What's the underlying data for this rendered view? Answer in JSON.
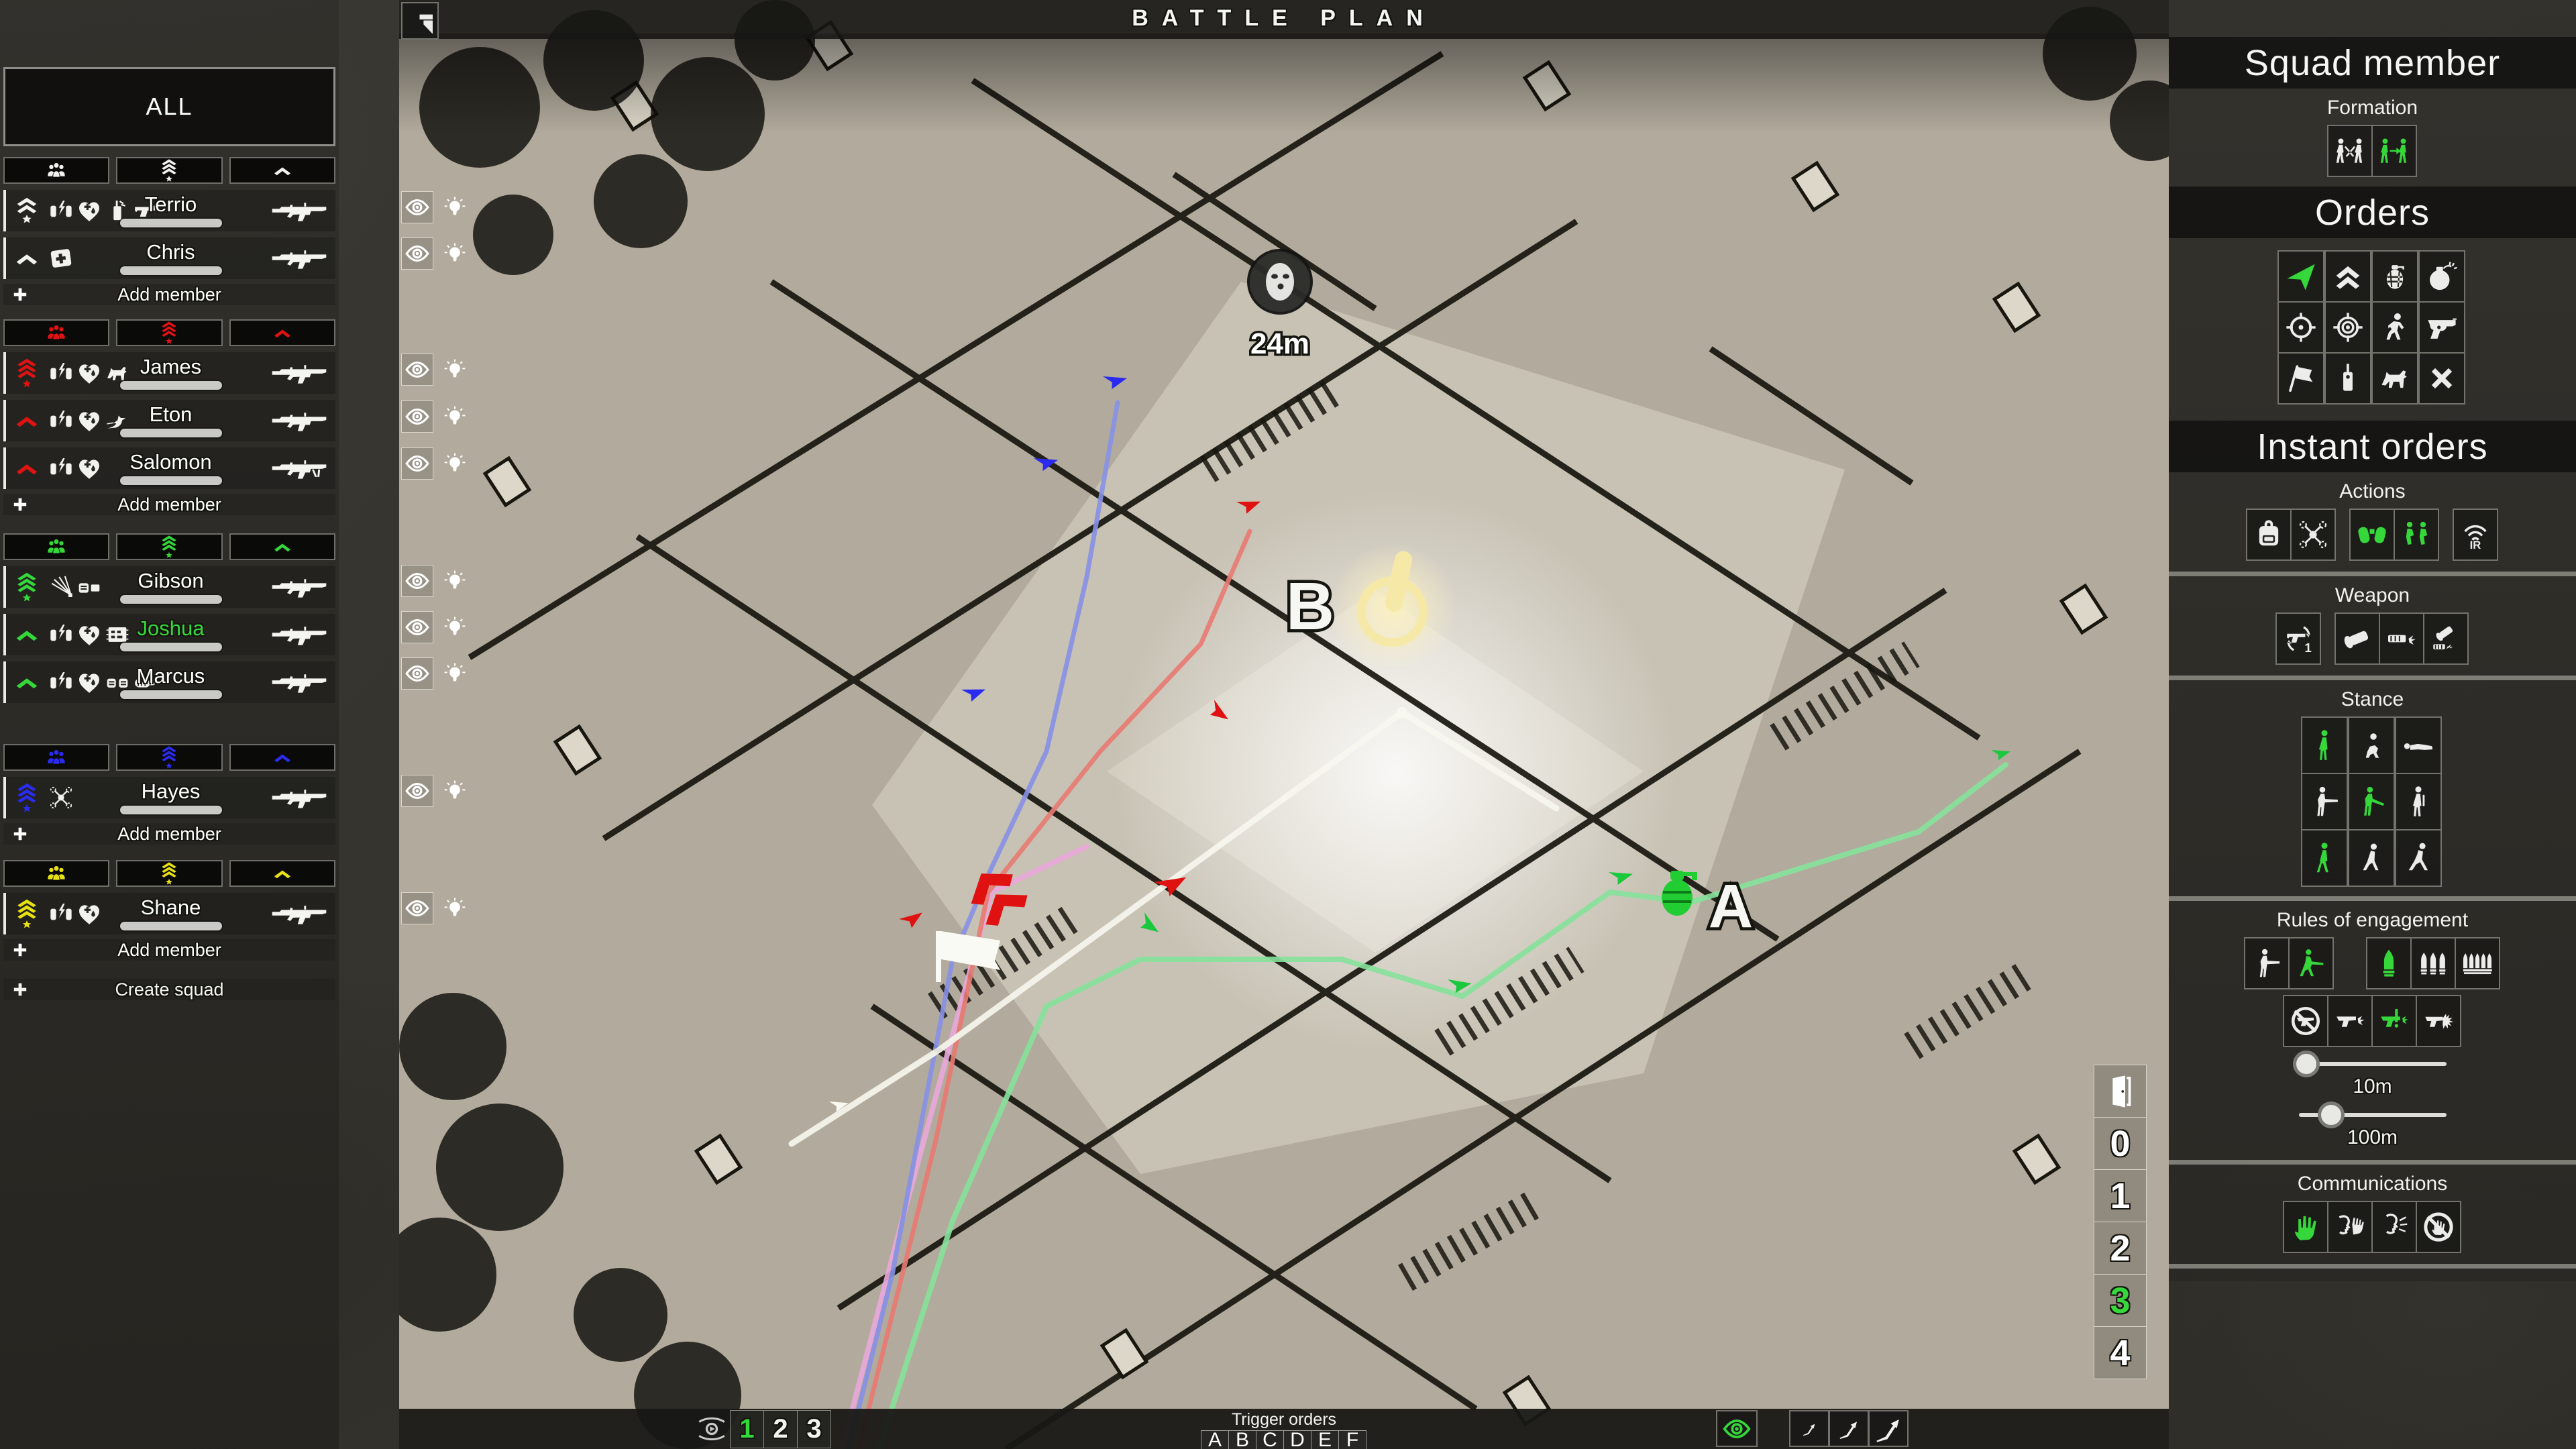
{
  "colors": {
    "accent_green": "#35d73a",
    "squad_white": "#f2f2ee",
    "squad_red": "#e01313",
    "squad_green": "#35d73a",
    "squad_blue": "#2b2bf0",
    "squad_yellow": "#e8e112"
  },
  "title_bar": {
    "title": "BATTLE PLAN"
  },
  "left_panel": {
    "all_label": "ALL",
    "filter_icons": [
      "group",
      "rank-3-star",
      "chevron"
    ],
    "squads": [
      {
        "color": "#f2f2ee",
        "add_label": "Add member",
        "members": [
          {
            "name": "Terrio",
            "rank": "rank-2-star",
            "skills": [
              "hands-lightning",
              "heart-medic",
              "radio",
              "pistol-small"
            ],
            "weapon": "rifle"
          },
          {
            "name": "Chris",
            "rank": "chevron",
            "skills": [
              "medkit"
            ],
            "weapon": "rifle"
          }
        ]
      },
      {
        "color": "#e01313",
        "add_label": "Add member",
        "members": [
          {
            "name": "James",
            "rank": "rank-3-star",
            "skills": [
              "hands-lightning",
              "heart-medic",
              "dog"
            ],
            "weapon": "rifle"
          },
          {
            "name": "Eton",
            "rank": "chevron",
            "skills": [
              "hands-lightning",
              "heart-medic",
              "bird"
            ],
            "weapon": "rifle"
          },
          {
            "name": "Salomon",
            "rank": "chevron",
            "skills": [
              "hands-lightning",
              "heart-medic"
            ],
            "weapon": "machine-gun"
          }
        ]
      },
      {
        "color": "#35d73a",
        "members": [
          {
            "name": "Gibson",
            "rank": "rank-3-star",
            "skills": [
              "breach-spray",
              "fist-wall"
            ],
            "weapon": "rifle"
          },
          {
            "name": "Joshua",
            "rank": "chevron",
            "skills": [
              "hands-lightning",
              "heart-medic",
              "circuit-board"
            ],
            "weapon": "rifle",
            "selected": true
          },
          {
            "name": "Marcus",
            "rank": "chevron",
            "skills": [
              "hands-lightning",
              "heart-medic",
              "fists",
              "bandage"
            ],
            "weapon": "rifle"
          }
        ]
      },
      {
        "color": "#2b2bf0",
        "add_label": "Add member",
        "members": [
          {
            "name": "Hayes",
            "rank": "rank-3-star",
            "skills": [
              "drone"
            ],
            "weapon": "rifle"
          }
        ]
      },
      {
        "color": "#e8e112",
        "add_label": "Add member",
        "members": [
          {
            "name": "Shane",
            "rank": "rank-3-star",
            "skills": [
              "hands-lightning",
              "heart-medic"
            ],
            "weapon": "rifle"
          }
        ]
      }
    ],
    "create_label": "Create squad"
  },
  "map": {
    "enemy_distance": "24m",
    "objective_a_label": "A",
    "objective_b_label": "B",
    "member_rows": [
      309,
      378,
      551,
      621,
      691,
      866,
      935,
      1004,
      1179,
      1354
    ],
    "floor_selector": {
      "door_icon": "door",
      "levels": [
        {
          "label": "0"
        },
        {
          "label": "1"
        },
        {
          "label": "2"
        },
        {
          "label": "3",
          "sel": true
        },
        {
          "label": "4"
        }
      ]
    }
  },
  "right_panel": {
    "squad_member_title": "Squad member",
    "formation_label": "Formation",
    "formation_options": [
      {
        "icon": "men-cross"
      },
      {
        "icon": "men-arrow",
        "sel": true
      }
    ],
    "orders_title": "Orders",
    "orders": [
      {
        "icon": "move-arrow",
        "sel": true
      },
      {
        "icon": "rush-chevrons"
      },
      {
        "icon": "grenade"
      },
      {
        "icon": "bomb"
      },
      {
        "icon": "crosshair"
      },
      {
        "icon": "focus-target"
      },
      {
        "icon": "crouch-run"
      },
      {
        "icon": "pistol-big"
      },
      {
        "icon": "flag"
      },
      {
        "icon": "detonator"
      },
      {
        "icon": "dog"
      },
      {
        "icon": "cancel-x"
      }
    ],
    "instant_orders_title": "Instant orders",
    "actions_label": "Actions",
    "actions_g1": [
      {
        "icon": "backpack"
      },
      {
        "icon": "drone"
      }
    ],
    "actions_g2": [
      {
        "icon": "binoculars",
        "sel": true
      },
      {
        "icon": "kneel-duo",
        "sel": true
      }
    ],
    "actions_g3": [
      {
        "icon": "ir-light"
      }
    ],
    "weapon_label": "Weapon",
    "weapon_g1": [
      {
        "icon": "pistol-swap"
      }
    ],
    "weapon_g2": [
      {
        "icon": "flashlight"
      },
      {
        "icon": "suppressor"
      },
      {
        "icon": "flash-suppressor"
      }
    ],
    "stance_label": "Stance",
    "stance": [
      {
        "icon": "stance-stand",
        "sel": true
      },
      {
        "icon": "stance-crouch"
      },
      {
        "icon": "stance-prone"
      },
      {
        "icon": "stance-aim"
      },
      {
        "icon": "stance-low",
        "sel": true
      },
      {
        "icon": "stance-relax"
      },
      {
        "icon": "stance-walk",
        "sel": true
      },
      {
        "icon": "stance-jog"
      },
      {
        "icon": "stance-run"
      }
    ],
    "roe_label": "Rules of engagement",
    "roe_g1": [
      {
        "icon": "roe-hold"
      },
      {
        "icon": "roe-advance",
        "sel": true
      }
    ],
    "roe_bullets": [
      {
        "icon": "bullet-1",
        "sel": true
      },
      {
        "icon": "bullet-3"
      },
      {
        "icon": "bullet-5"
      }
    ],
    "roe_fire": [
      {
        "icon": "no-fire"
      },
      {
        "icon": "fire-single"
      },
      {
        "icon": "fire-warn",
        "sel": true
      },
      {
        "icon": "fire-burst"
      }
    ],
    "sliders": [
      {
        "label": "10m",
        "pos": 0.05
      },
      {
        "label": "100m",
        "pos": 0.22
      }
    ],
    "comms_label": "Communications",
    "comms": [
      {
        "icon": "hand-signal",
        "sel": true
      },
      {
        "icon": "whisper"
      },
      {
        "icon": "shout"
      },
      {
        "icon": "no-comms"
      }
    ]
  },
  "bottom_bar": {
    "plan_tabs": [
      {
        "label": "1",
        "sel": true
      },
      {
        "label": "2"
      },
      {
        "label": "3"
      }
    ],
    "trigger_label": "Trigger orders",
    "triggers": [
      {
        "label": "A"
      },
      {
        "label": "B"
      },
      {
        "label": "C"
      },
      {
        "label": "D"
      },
      {
        "label": "E"
      },
      {
        "label": "F"
      }
    ],
    "path_scale": [
      {
        "icon": "path-arrow",
        "size": "s"
      },
      {
        "icon": "path-arrow",
        "size": "m",
        "sel": true
      },
      {
        "icon": "path-arrow",
        "size": "l"
      }
    ]
  }
}
